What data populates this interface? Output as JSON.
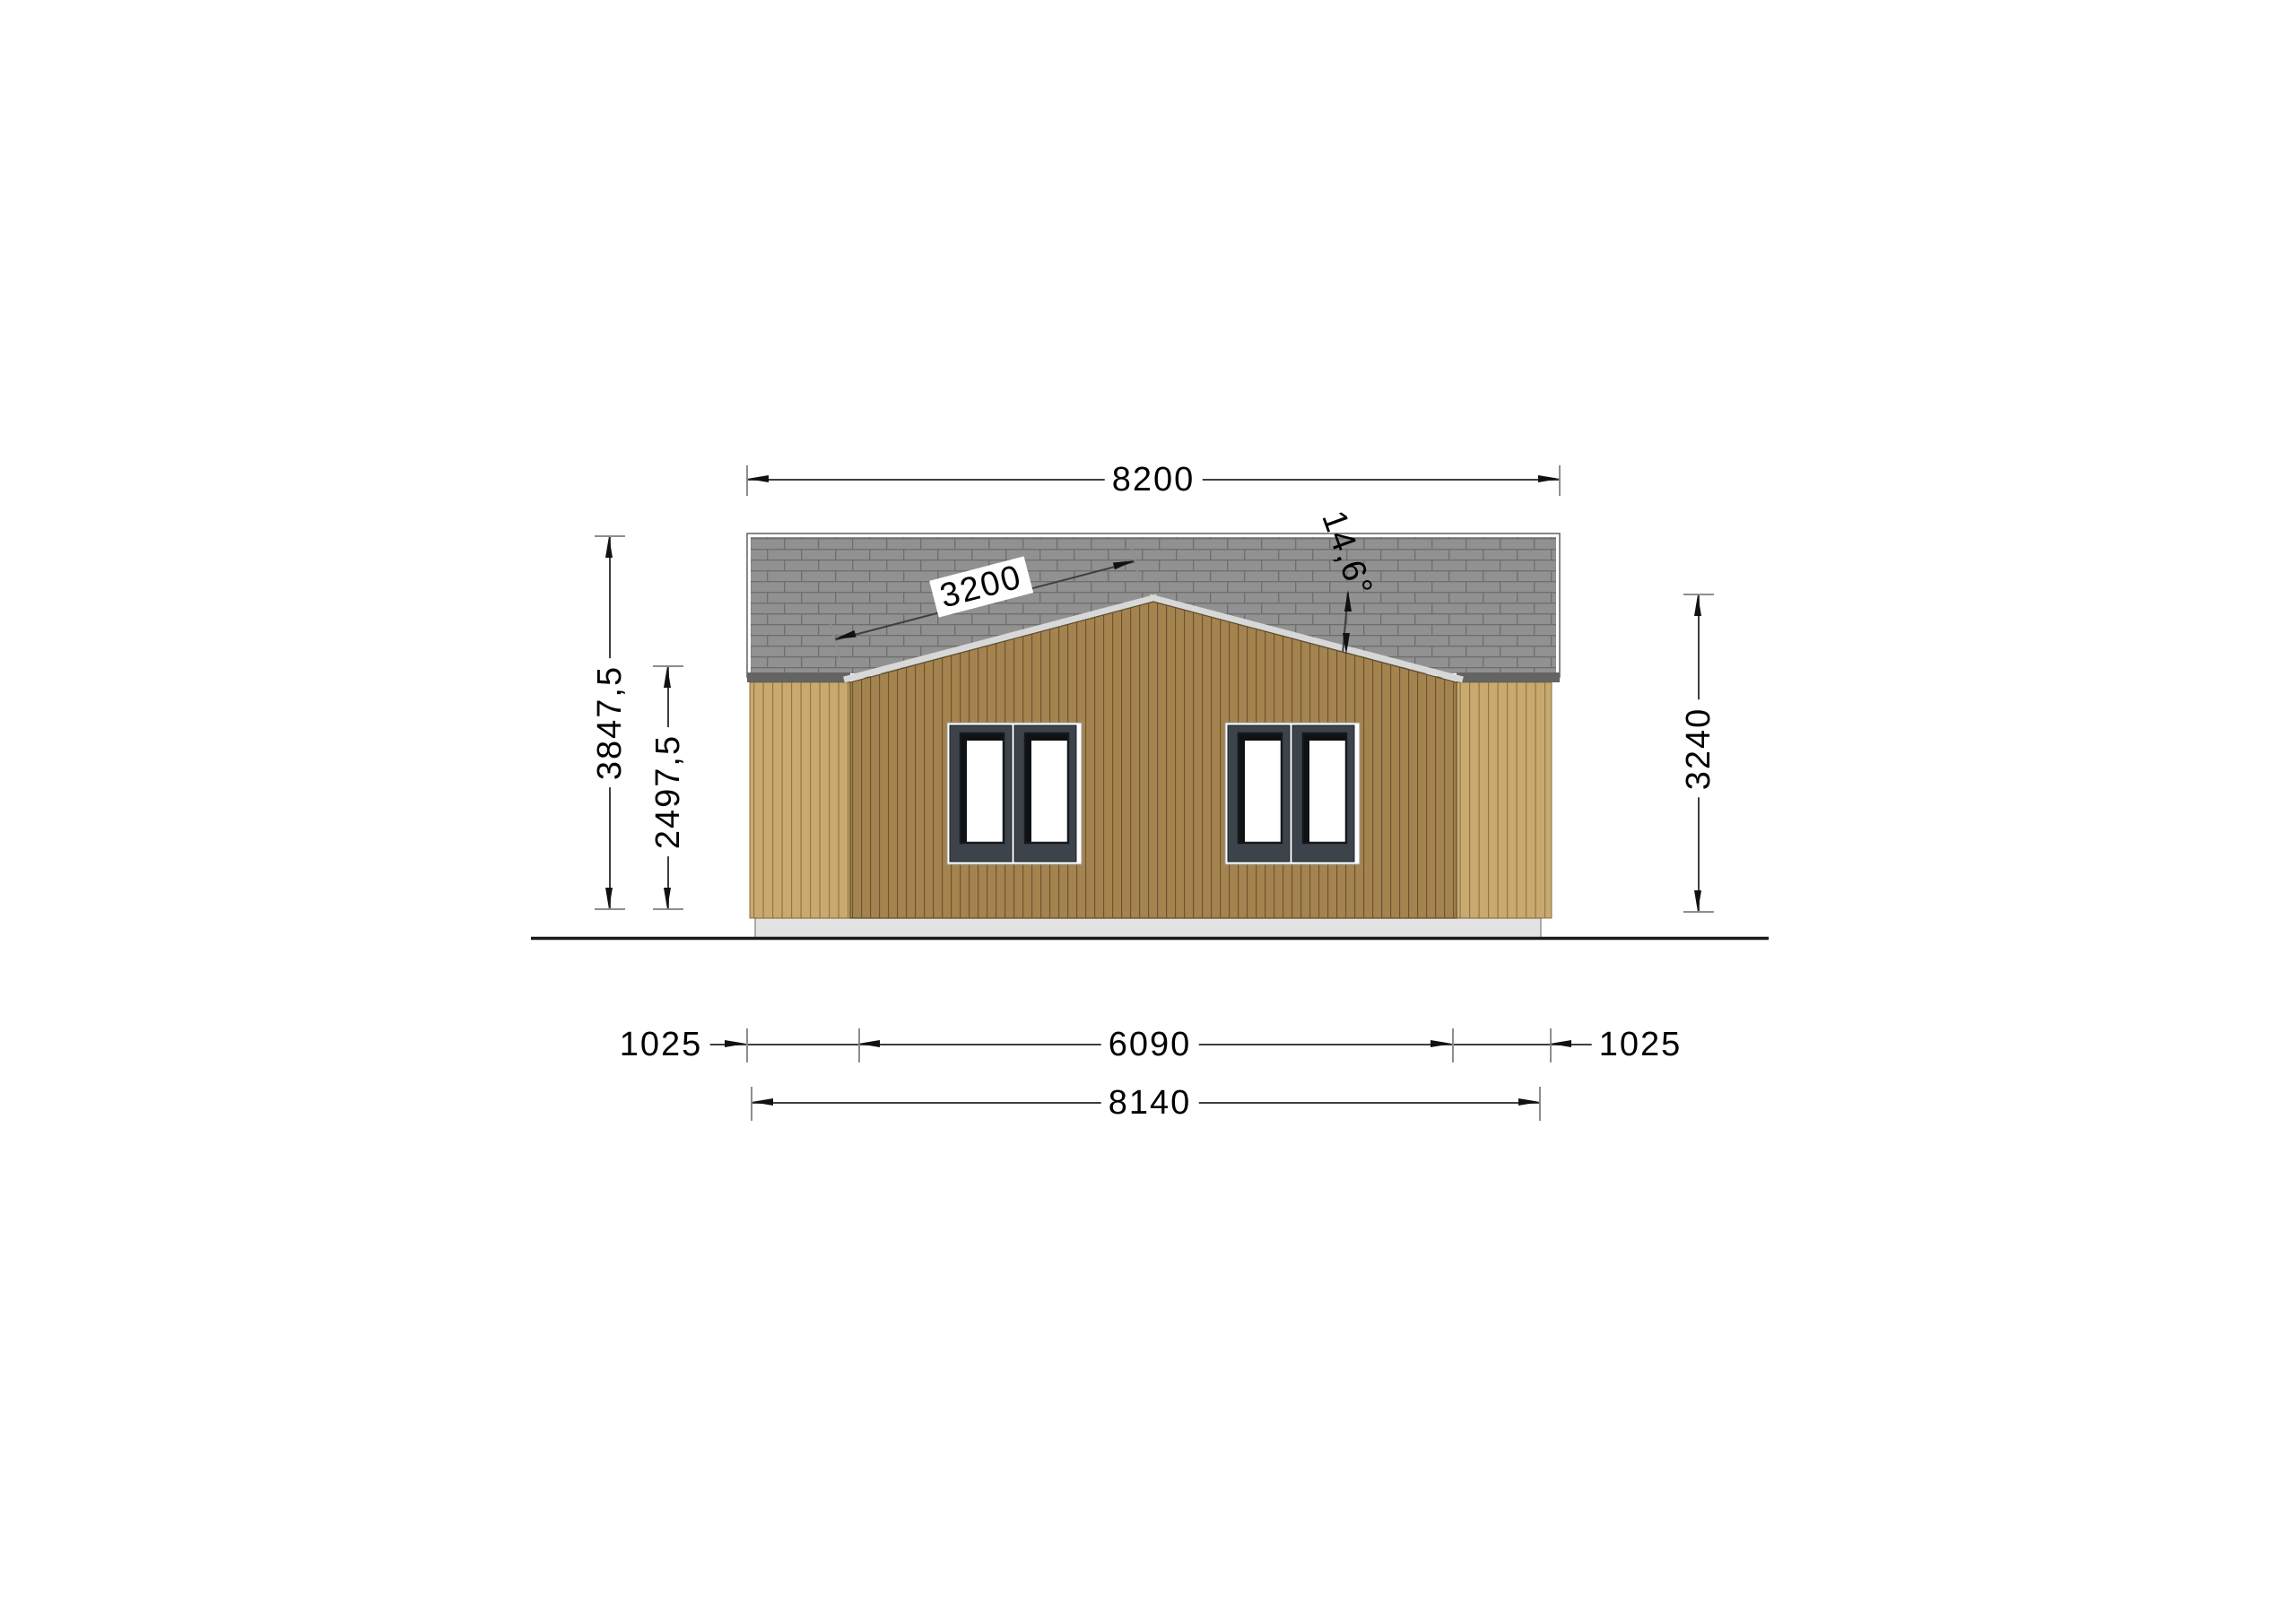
{
  "drawing": {
    "kind": "house side elevation, technical dimension drawing",
    "ground": true
  },
  "dims": {
    "roof_width": "8200",
    "slope_length": "3200",
    "roof_angle": "14,6°",
    "total_height": "3847,5",
    "wall_height": "2497,5",
    "ridge_height": "3240",
    "left_offset": "1025",
    "center_width": "6090",
    "right_offset": "1025",
    "base_width": "8140"
  },
  "colors": {
    "roof_shingle": "#919191",
    "roof_mortar_line": "#6f6f6f",
    "eave_edge": "#646464",
    "wing_wood": "#c9a96e",
    "wing_wood_line": "#8f7848",
    "gable_wood": "#a5834f",
    "gable_wood_line": "#6a5632",
    "fascia_trim": "#d8d8d8",
    "foundation": "#e3e3e3",
    "window_frame": "#3c434b",
    "dimension_line": "#3f3f3f",
    "text": "#000000"
  }
}
